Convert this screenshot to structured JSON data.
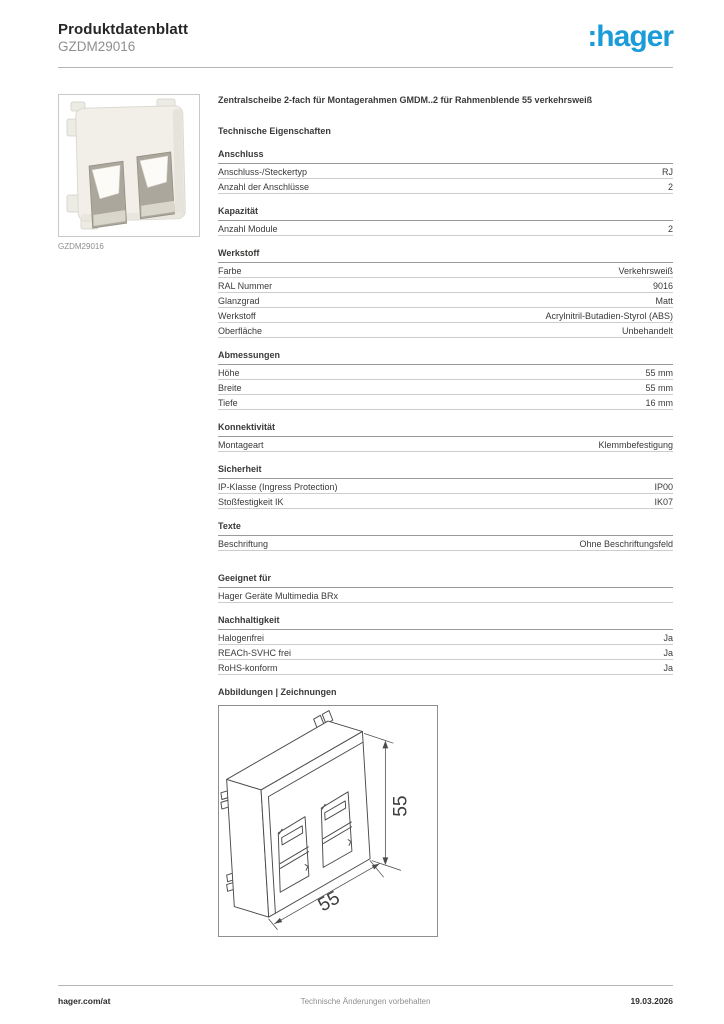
{
  "header": {
    "doc_type": "Produktdatenblatt",
    "product_ref": "GZDM29016",
    "brand_logo": ":hager",
    "brand_color": "#1B9CD8"
  },
  "product_image": {
    "caption": "GZDM29016"
  },
  "description": "Zentralscheibe 2-fach für Montagerahmen GMDM..2 für Rahmenblende 55 verkehrsweiß",
  "tech_heading": "Technische Eigenschaften",
  "spec_sections": [
    {
      "title": "Anschluss",
      "rows": [
        {
          "label": "Anschluss-/Steckertyp",
          "value": "RJ"
        },
        {
          "label": "Anzahl der Anschlüsse",
          "value": "2"
        }
      ]
    },
    {
      "title": "Kapazität",
      "rows": [
        {
          "label": "Anzahl Module",
          "value": "2"
        }
      ]
    },
    {
      "title": "Werkstoff",
      "rows": [
        {
          "label": "Farbe",
          "value": "Verkehrsweiß"
        },
        {
          "label": "RAL Nummer",
          "value": "9016"
        },
        {
          "label": "Glanzgrad",
          "value": "Matt"
        },
        {
          "label": "Werkstoff",
          "value": "Acrylnitril-Butadien-Styrol (ABS)"
        },
        {
          "label": "Oberfläche",
          "value": "Unbehandelt"
        }
      ]
    },
    {
      "title": "Abmessungen",
      "rows": [
        {
          "label": "Höhe",
          "value": "55 mm"
        },
        {
          "label": "Breite",
          "value": "55 mm"
        },
        {
          "label": "Tiefe",
          "value": "16 mm"
        }
      ]
    },
    {
      "title": "Konnektivität",
      "rows": [
        {
          "label": "Montageart",
          "value": "Klemmbefestigung"
        }
      ]
    },
    {
      "title": "Sicherheit",
      "rows": [
        {
          "label": "IP-Klasse (Ingress Protection)",
          "value": "IP00"
        },
        {
          "label": "Stoßfestigkeit IK",
          "value": "IK07"
        }
      ]
    },
    {
      "title": "Texte",
      "rows": [
        {
          "label": "Beschriftung",
          "value": "Ohne Beschriftungsfeld"
        }
      ]
    },
    {
      "title": "Geeignet für",
      "extra_gap": true,
      "rows": [
        {
          "label": "Hager Geräte Multimedia BRx",
          "value": ""
        }
      ]
    },
    {
      "title": "Nachhaltigkeit",
      "rows": [
        {
          "label": "Halogenfrei",
          "value": "Ja"
        },
        {
          "label": "REACh-SVHC frei",
          "value": "Ja"
        },
        {
          "label": "RoHS-konform",
          "value": "Ja"
        }
      ]
    }
  ],
  "drawings": {
    "heading": "Abbildungen | Zeichnungen",
    "height_dim": "55",
    "width_dim": "55"
  },
  "footer": {
    "website": "hager.com/at",
    "notice": "Technische Änderungen vorbehalten",
    "date": "19.03.2026"
  }
}
